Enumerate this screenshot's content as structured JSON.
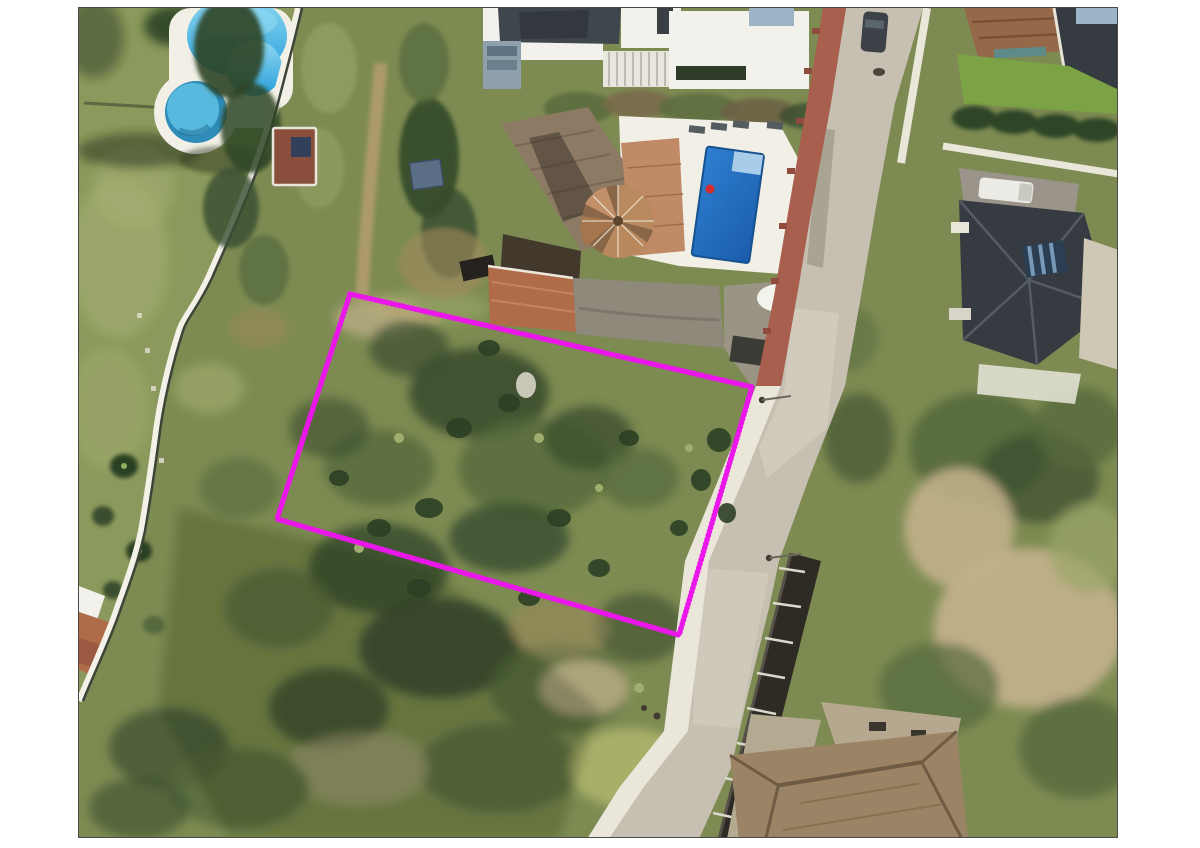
{
  "page": {
    "background": "#ffffff"
  },
  "photo": {
    "kind": "aerial-satellite-photo",
    "description": "Aerial view of an undeveloped scrubland building plot outlined with a magenta dotted boundary, between a landscaped garden with a kidney-shaped communal pool (left), a villa with tiled roof, round tower and private pool (top), and a curving residential street with neighbouring villas (right and bottom).",
    "frame": {
      "left": 78,
      "top": 7,
      "width": 1040,
      "height": 831,
      "border_color": "#4a4a4a"
    }
  },
  "plot_boundary": {
    "color": "#ea16ea",
    "stroke_width": 5.5,
    "dash": "0.8 3.4",
    "points": "271,286 673,379 600,627 198,511"
  },
  "features": [
    {
      "name": "community-pool",
      "description": "Kidney-shaped communal swimming pool, top left"
    },
    {
      "name": "kids-pool",
      "description": "Small round children's pool beside the main pool"
    },
    {
      "name": "lawn-garden",
      "description": "Landscaped communal lawn with palms and path, left side"
    },
    {
      "name": "garden-boundary-path",
      "description": "Curved white path and dark fence between garden and plot"
    },
    {
      "name": "villa",
      "description": "Villa with tiled roof and round tower roof, top centre"
    },
    {
      "name": "villa-pool",
      "description": "Private rectangular pool on white terrace beside the villa"
    },
    {
      "name": "street",
      "description": "Curving residential street running top to bottom on the right"
    },
    {
      "name": "brick-sidewalk",
      "description": "Red brick pavement along the upper street edge"
    },
    {
      "name": "concrete-sidewalk",
      "description": "White concrete kerb along the lower street edge"
    },
    {
      "name": "retaining-wall",
      "description": "Dark retaining wall with parking bays along lower street"
    },
    {
      "name": "neighbour-houses",
      "description": "Villas with terracotta and dark hipped roofs, top right"
    },
    {
      "name": "bottom-house",
      "description": "Large tiled hip roof cut by the bottom edge"
    },
    {
      "name": "plot",
      "description": "Undeveloped scrub plot outlined in magenta"
    }
  ],
  "colors": {
    "page_bg": "#ffffff",
    "frame_border": "#4a4a4a",
    "scrub_base": "#7d8b52",
    "scrub_light": "#9aa568",
    "scrub_yellow": "#aeb26b",
    "lawn": "#8b9a5c",
    "lawn_light": "#a8b175",
    "lawn_bright": "#7ba244",
    "bush_dark": "#3a4d2e",
    "bush_mid": "#55693c",
    "bush_deep": "#2c3f24",
    "hedge_dark": "#2f4426",
    "dry_tan": "#c1b08a",
    "dry_light": "#d2c49e",
    "dry_brown": "#a08a5e",
    "road": "#c7c0b2",
    "road_light": "#d8d2c5",
    "road_shadow": "#8f8a7c",
    "sidewalk": "#eae6da",
    "brick": "#a85f4d",
    "brick_dark": "#8f4c3c",
    "wall_dark": "#2e2a24",
    "deck_white": "#f1efe6",
    "pool_blue": "#3fb0e4",
    "pool_deep": "#2aa0da",
    "pool_pale": "#8ed8f2",
    "kids_pool": "#58b9de",
    "kids_pool_deep": "#2f8cb8",
    "villa_pool": "#2e7fd0",
    "villa_pool_deep": "#1b5cab",
    "pool_steps": "#a9cce8",
    "tile_roof": "#8d7a64",
    "tile_roof_dark": "#6e5c4c",
    "salmon_roof": "#c18a66",
    "terracotta": "#b06c49",
    "terracotta_light": "#c98a63",
    "roof_dark_brown": "#42382c",
    "slate_roof": "#3f464d",
    "slate_dark": "#32383e",
    "house_dark": "#363b41",
    "ridge_light": "#5a6068",
    "white_bldg": "#f2f1ec",
    "brown_roof_tr": "#96684a",
    "bottom_roof": "#9b8465",
    "bottom_roof_dark": "#6e5b44",
    "courtyard_gray": "#8f897c",
    "pavement_gray": "#9a9484",
    "teal_awning": "#5e8a8a",
    "skylight": "#7899b8",
    "magenta": "#ea16ea",
    "shadow_green": "#1e2a14"
  }
}
